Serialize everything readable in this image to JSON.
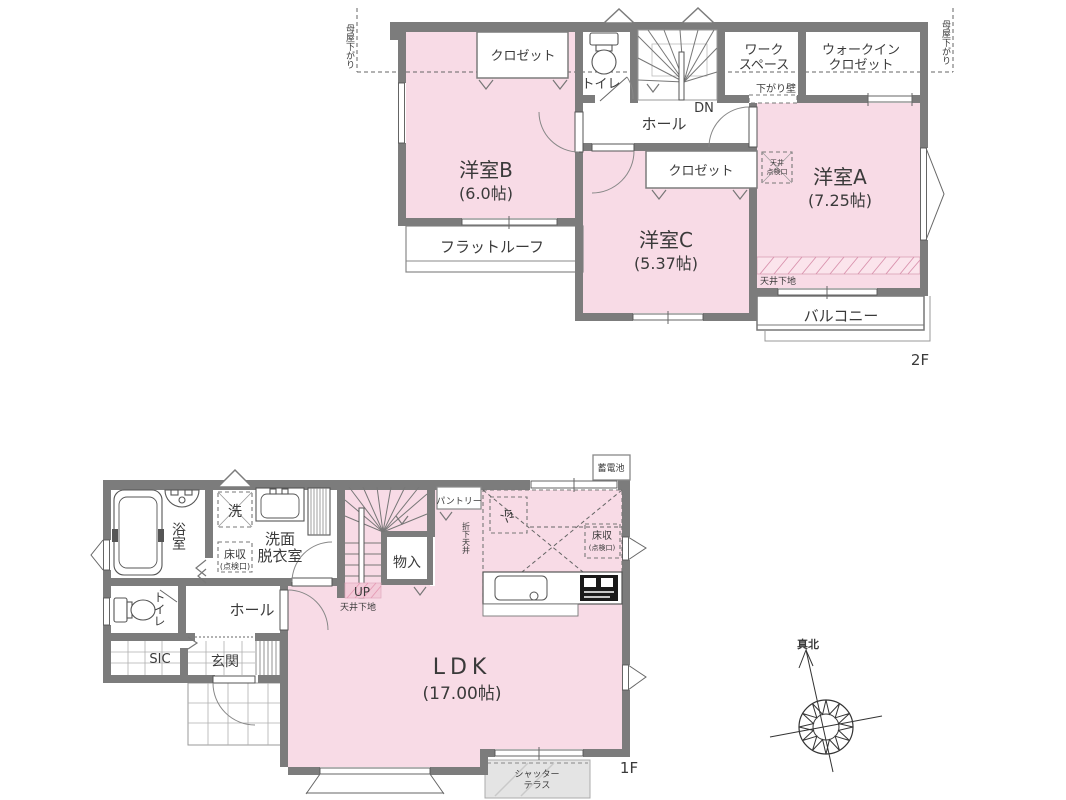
{
  "floor2": {
    "label": "2F",
    "rooms": {
      "room_b": {
        "name": "洋室B",
        "size": "(6.0帖)"
      },
      "room_a": {
        "name": "洋室A",
        "size": "(7.25帖)"
      },
      "room_c": {
        "name": "洋室C",
        "size": "(5.37帖)"
      },
      "closet_top": "クロゼット",
      "closet_c": "クロゼット",
      "toilet": "トイレ",
      "hall": "ホール",
      "workspace": [
        "ワーク",
        "スペース"
      ],
      "walkin_closet": [
        "ウォークイン",
        "クロゼット"
      ],
      "flat_roof": "フラットルーフ",
      "balcony": "バルコニー"
    },
    "annotations": {
      "dn": "DN",
      "sagari_kabe": "下がり壁",
      "tenjo_shitaji": "天井下地",
      "tenjo_tenkenko": [
        "天井",
        "点検口"
      ],
      "moya_sagari_left": "母屋下がり",
      "moya_sagari_right": "母屋下がり"
    }
  },
  "floor1": {
    "label": "1F",
    "rooms": {
      "ldk": {
        "name": "LDK",
        "size": "(17.00帖)"
      },
      "bath": "浴室",
      "washroom": [
        "洗面",
        "脱衣室"
      ],
      "toilet": "トイレ",
      "hall": "ホール",
      "sic": "SIC",
      "genkan": "玄関",
      "mono_ire": "物入",
      "pantry": "パントリー",
      "shutter_terrace": [
        "シャッター",
        "テラス"
      ]
    },
    "annotations": {
      "up": "UP",
      "tenjo_shitaji": "天井下地",
      "washer": "洗",
      "yuka_shu": [
        "床収",
        "(点検口)"
      ],
      "yuka_shu_kitchen": [
        "床収",
        "(点検口)"
      ],
      "fridge": "冷",
      "orishita_tenjo": "折下天井",
      "battery": "蓄電池"
    }
  },
  "compass": {
    "label": "真北"
  },
  "colors": {
    "room_pink": "#f8dbe6",
    "wall_gray": "#7c7c7c",
    "hatch_pink": "#d991ad",
    "terrace_gray": "#e4e4e4"
  }
}
